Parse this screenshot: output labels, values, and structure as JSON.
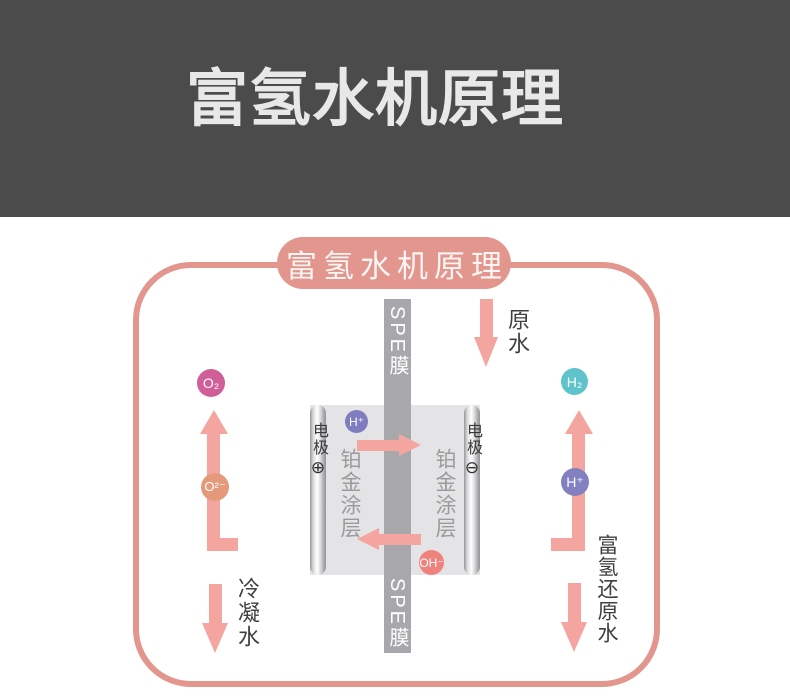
{
  "header": {
    "title": "富氢水机原理",
    "bg_color": "#4b4b4b",
    "text_color": "#e8e8e8"
  },
  "diagram": {
    "badge_label": "富氢水机原理",
    "frame_color": "#e2968d",
    "arrow_color": "#f5a5a0",
    "membrane": {
      "top_label": "SPE膜",
      "bottom_label": "SPE膜",
      "color": "#a8a8ac"
    },
    "cell": {
      "bg_color": "#e4e4e6",
      "left_electrode": {
        "label": "电极",
        "polarity": "⊕"
      },
      "right_electrode": {
        "label": "电极",
        "polarity": "⊖"
      },
      "left_coating": "铂金涂层",
      "right_coating": "铂金涂层"
    },
    "ions": {
      "o2": {
        "label": "O₂",
        "color": "#d05f99"
      },
      "h2": {
        "label": "H₂",
        "color": "#5fc3cc"
      },
      "o2minus": {
        "label": "O²⁻",
        "color": "#e5997b"
      },
      "hplus_right": {
        "label": "H⁺",
        "color": "#8280c0"
      },
      "hplus_cell": {
        "label": "H⁺",
        "color": "#7f7dbf"
      },
      "ohminus": {
        "label": "OH⁻",
        "color": "#f0827e"
      }
    },
    "flows": {
      "raw_water": "原水",
      "condensed_water": "冷凝水",
      "hydrogen_rich_water": "富氢还原水"
    }
  }
}
